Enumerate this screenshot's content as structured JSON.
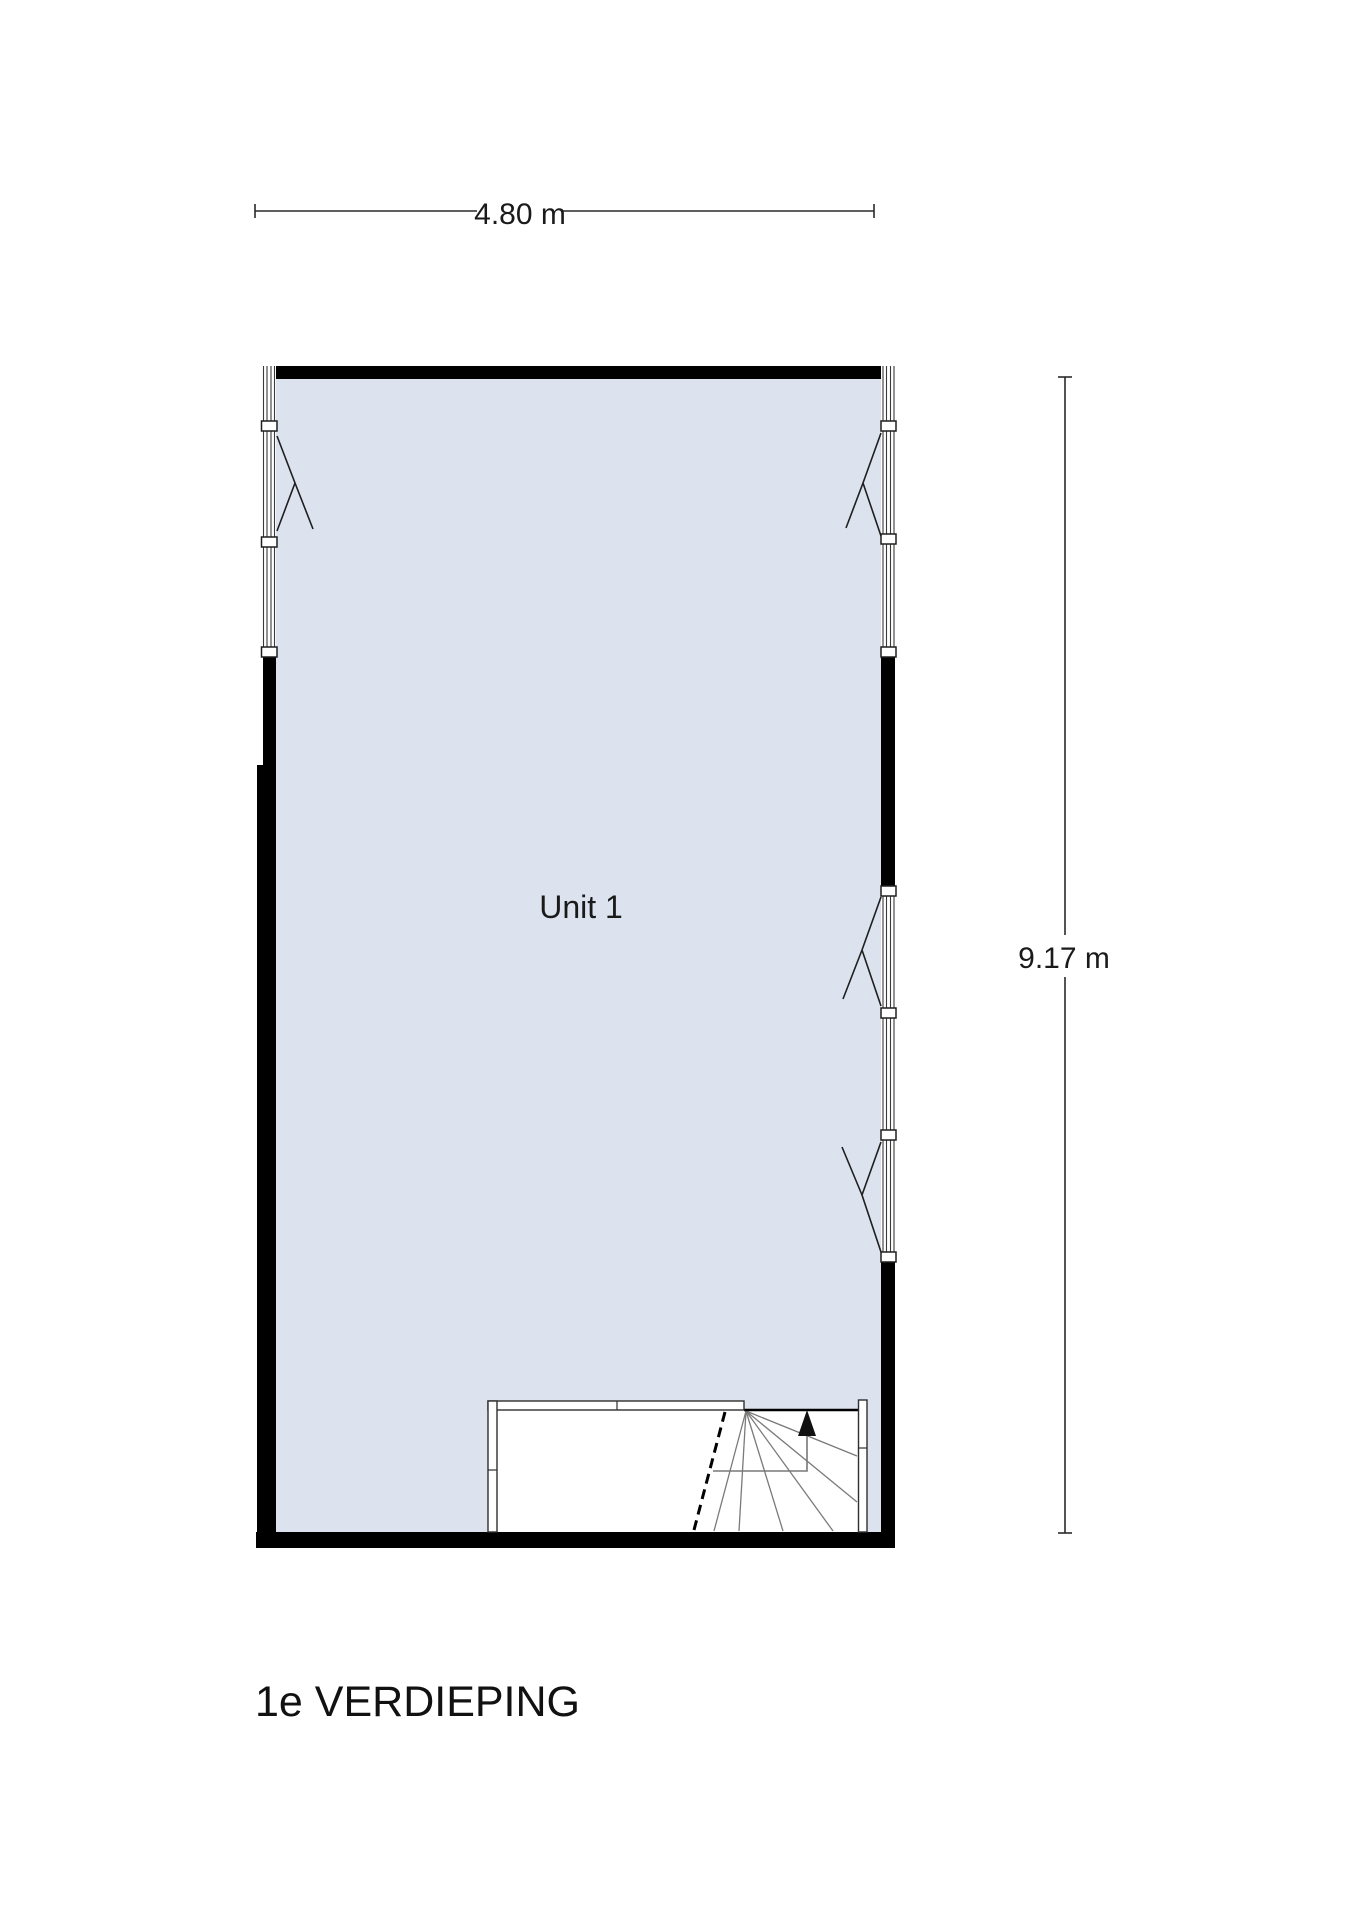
{
  "floor_plan": {
    "title": "1e VERDIEPING",
    "room": {
      "label": "Unit 1"
    },
    "dimensions": {
      "width": {
        "label": "4.80 m",
        "meters": 4.8
      },
      "height": {
        "label": "9.17 m",
        "meters": 9.17
      }
    },
    "colors": {
      "floor_fill": "#dce3ef",
      "wall": "#000000",
      "tread": "#7a7a7a",
      "text": "#1a1a1a"
    }
  }
}
